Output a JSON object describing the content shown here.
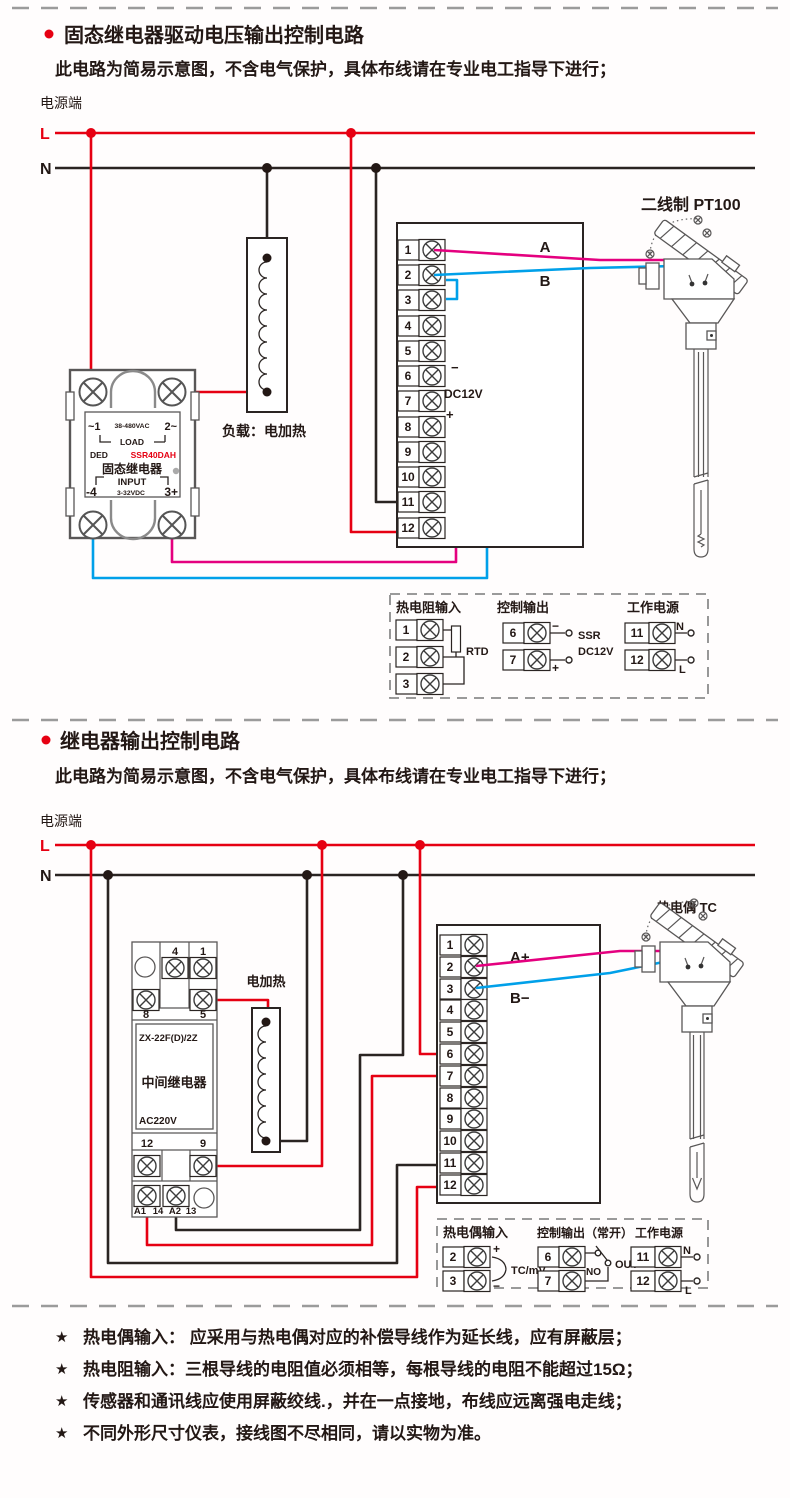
{
  "colors": {
    "wire_red": "#e60012",
    "wire_magenta": "#e4007f",
    "wire_blue": "#00a0e9",
    "line_black": "#2a2422",
    "component_gray": "#595757",
    "dash_gray": "#9b9b9b",
    "model_red": "#e60012"
  },
  "s1": {
    "title": "固态继电器驱动电压输出控制电路",
    "subtitle": "此电路为简易示意图，不含电气保护，具体布线请在专业电工指导下进行；",
    "power_label": "电源端",
    "l": "L",
    "n": "N",
    "ssr": {
      "t1": "~1",
      "vac": "38-480VAC",
      "t2": "2~",
      "load": "LOAD",
      "brand": "DED",
      "model": "SSR40DAH",
      "name": "固态继电器",
      "input": "INPUT",
      "in_neg": "-4",
      "vdc": "3-32VDC",
      "in_pos": "3+"
    },
    "heater_label": "负载：电加热",
    "sensor_label": "二线制 PT100",
    "wire_a": "A",
    "wire_b": "B",
    "out_minus": "−",
    "out_plus": "+",
    "out_dc": "DC12V",
    "t": [
      "1",
      "2",
      "3",
      "4",
      "5",
      "6",
      "7",
      "8",
      "9",
      "10",
      "11",
      "12"
    ],
    "legend": {
      "rtd_title": "热电阻输入",
      "rtd_t": [
        "1",
        "2",
        "3"
      ],
      "rtd": "RTD",
      "out_title": "控制输出",
      "out_t": [
        "6",
        "7"
      ],
      "minus": "−",
      "plus": "+",
      "ssr": "SSR",
      "dc": "DC12V",
      "pwr_title": "工作电源",
      "pwr_t": [
        "11",
        "12"
      ],
      "n": "N",
      "l": "L"
    }
  },
  "s2": {
    "title": "继电器输出控制电路",
    "subtitle": "此电路为简易示意图，不含电气保护，具体布线请在专业电工指导下进行；",
    "power_label": "电源端",
    "l": "L",
    "n": "N",
    "relay": {
      "r1a": "4",
      "r1b": "1",
      "r2a": "8",
      "r2b": "5",
      "model": "ZX-22F(D)/2Z",
      "name": "中间继电器",
      "volt": "AC220V",
      "r3a": "12",
      "r3b": "9",
      "r4a": "A1",
      "r4b": "14",
      "r4c": "A2",
      "r4d": "13"
    },
    "heater_label": "电加热",
    "sensor_label": "热电偶 TC",
    "wire_a": "A+",
    "wire_b": "B−",
    "t": [
      "1",
      "2",
      "3",
      "4",
      "5",
      "6",
      "7",
      "8",
      "9",
      "10",
      "11",
      "12"
    ],
    "legend": {
      "tc_title": "热电偶输入",
      "tc_t": [
        "2",
        "3"
      ],
      "plus": "+",
      "minus": "−",
      "tcmv": "TC/mV",
      "out_title": "控制输出（常开）",
      "out_t": [
        "6",
        "7"
      ],
      "no": "NO",
      "out": "OUT",
      "pwr_title": "工作电源",
      "pwr_t": [
        "11",
        "12"
      ],
      "n": "N",
      "l": "L"
    }
  },
  "notes": {
    "star": "★",
    "items": [
      "热电偶输入： 应采用与热电偶对应的补偿导线作为延长线，应有屏蔽层；",
      "热电阻输入：三根导线的电阻值必须相等，每根导线的电阻不能超过15Ω；",
      "传感器和通讯线应使用屏蔽绞线.，并在一点接地，布线应远离强电走线；",
      "不同外形尺寸仪表，接线图不尽相同，请以实物为准。"
    ]
  }
}
